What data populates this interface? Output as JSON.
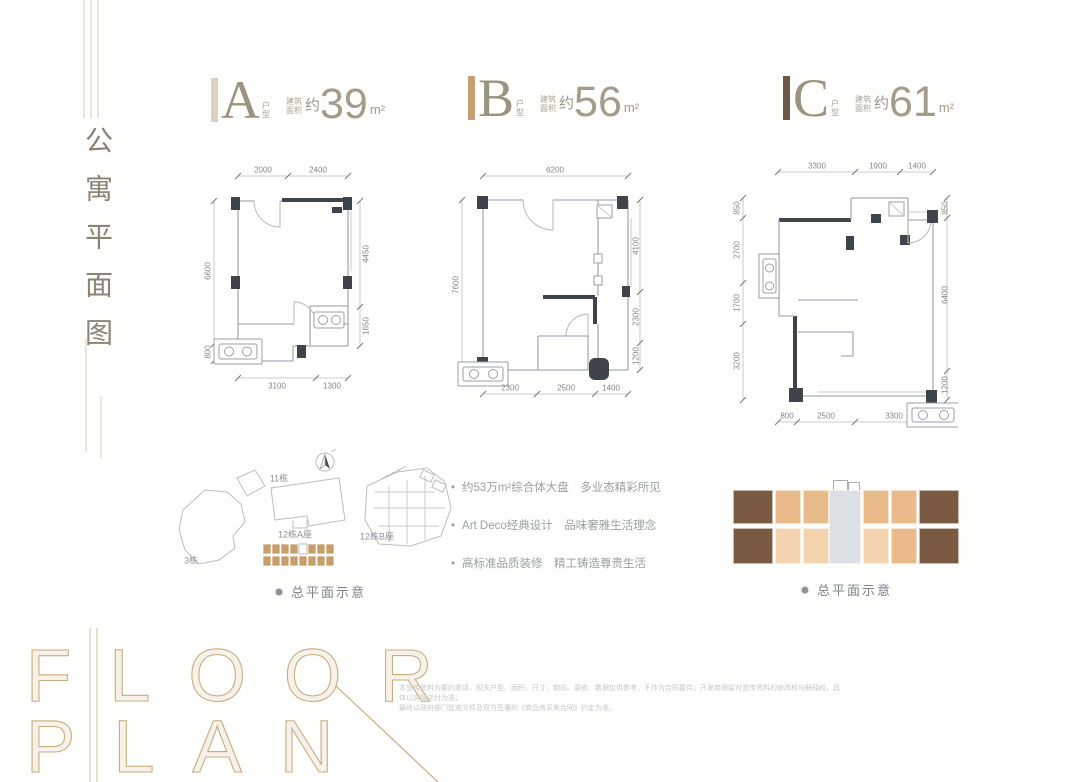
{
  "page_title": "公寓平面图",
  "watermark": {
    "line1": "FLOOR",
    "line2": "PLAN",
    "accent_color": "#c8ad80"
  },
  "units": [
    {
      "letter": "A",
      "type_label_1": "户",
      "type_label_2": "型",
      "area_prefix_1": "建筑",
      "area_prefix_2": "面积",
      "approx": "约",
      "area_value": "39",
      "area_unit": "m²",
      "bar_color": "#dad2c3"
    },
    {
      "letter": "B",
      "type_label_1": "户",
      "type_label_2": "型",
      "area_prefix_1": "建筑",
      "area_prefix_2": "面积",
      "approx": "约",
      "area_value": "56",
      "area_unit": "m²",
      "bar_color": "#c59e72"
    },
    {
      "letter": "C",
      "type_label_1": "户",
      "type_label_2": "型",
      "area_prefix_1": "建筑",
      "area_prefix_2": "面积",
      "approx": "约",
      "area_value": "61",
      "area_unit": "m²",
      "bar_color": "#6d5847"
    }
  ],
  "floorplans": {
    "a": {
      "dims": [
        {
          "t": "2000",
          "x": 65,
          "y": 14
        },
        {
          "t": "2400",
          "x": 120,
          "y": 14
        },
        {
          "t": "6600",
          "x": 10,
          "y": 115,
          "v": 1
        },
        {
          "t": "800",
          "x": 10,
          "y": 196,
          "v": 1
        },
        {
          "t": "4450",
          "x": 168,
          "y": 98,
          "v": 1
        },
        {
          "t": "1650",
          "x": 168,
          "y": 170,
          "v": 1
        },
        {
          "t": "3100",
          "x": 79,
          "y": 230
        },
        {
          "t": "1300",
          "x": 134,
          "y": 230
        }
      ]
    },
    "b": {
      "dims": [
        {
          "t": "6200",
          "x": 107,
          "y": 12
        },
        {
          "t": "7600",
          "x": 8,
          "y": 127,
          "v": 1
        },
        {
          "t": "4100",
          "x": 188,
          "y": 88,
          "v": 1
        },
        {
          "t": "2300",
          "x": 188,
          "y": 159,
          "v": 1
        },
        {
          "t": "1200",
          "x": 188,
          "y": 198,
          "v": 1
        },
        {
          "t": "2300",
          "x": 62,
          "y": 230
        },
        {
          "t": "2500",
          "x": 118,
          "y": 230
        },
        {
          "t": "1400",
          "x": 163,
          "y": 230
        }
      ]
    },
    "c": {
      "dims": [
        {
          "t": "3300",
          "x": 94,
          "y": 16
        },
        {
          "t": "1900",
          "x": 155,
          "y": 16
        },
        {
          "t": "1400",
          "x": 194,
          "y": 16
        },
        {
          "t": "850",
          "x": 14,
          "y": 58,
          "v": 1
        },
        {
          "t": "2700",
          "x": 14,
          "y": 100,
          "v": 1
        },
        {
          "t": "1700",
          "x": 14,
          "y": 153,
          "v": 1
        },
        {
          "t": "3200",
          "x": 14,
          "y": 211,
          "v": 1
        },
        {
          "t": "850",
          "x": 222,
          "y": 58,
          "v": 1
        },
        {
          "t": "6400",
          "x": 222,
          "y": 145,
          "v": 1
        },
        {
          "t": "1200",
          "x": 222,
          "y": 235,
          "v": 1
        },
        {
          "t": "800",
          "x": 64,
          "y": 266
        },
        {
          "t": "2500",
          "x": 103,
          "y": 266
        },
        {
          "t": "3300",
          "x": 171,
          "y": 266
        }
      ]
    }
  },
  "siteplan": {
    "labels": [
      {
        "t": "11栋",
        "x": 104,
        "y": 30
      },
      {
        "t": "12栋A座",
        "x": 120,
        "y": 86
      },
      {
        "t": "12栋B座",
        "x": 202,
        "y": 88
      },
      {
        "t": "3栋",
        "x": 16,
        "y": 112
      }
    ],
    "caption": "总平面示意"
  },
  "features": {
    "bullets": [
      "约53万m²综合体大盘　多业态精彩所见",
      "Art Deco经典设计　品味奢雅生活理念",
      "高标准品质装修　精工铸造尊贵生活"
    ]
  },
  "floorplate": {
    "caption": "总平面示意",
    "colors": {
      "dark": "#7a5a40",
      "tan": "#e9ba8a",
      "light": "#f3d4ae",
      "core": "#dce0e5"
    },
    "units": [
      {
        "x": 0,
        "y": 2,
        "w": 40,
        "h": 34,
        "c": "dark"
      },
      {
        "x": 0,
        "y": 40,
        "w": 40,
        "h": 36,
        "c": "dark"
      },
      {
        "x": 42,
        "y": 2,
        "w": 26,
        "h": 34,
        "c": "tan"
      },
      {
        "x": 70,
        "y": 2,
        "w": 26,
        "h": 34,
        "c": "tan"
      },
      {
        "x": 130,
        "y": 2,
        "w": 26,
        "h": 34,
        "c": "tan"
      },
      {
        "x": 158,
        "y": 2,
        "w": 26,
        "h": 34,
        "c": "tan"
      },
      {
        "x": 96,
        "y": 2,
        "w": 32,
        "h": 74,
        "c": "core"
      },
      {
        "x": 42,
        "y": 40,
        "w": 26,
        "h": 36,
        "c": "light"
      },
      {
        "x": 70,
        "y": 40,
        "w": 26,
        "h": 36,
        "c": "light"
      },
      {
        "x": 130,
        "y": 40,
        "w": 26,
        "h": 36,
        "c": "light"
      },
      {
        "x": 158,
        "y": 40,
        "w": 26,
        "h": 36,
        "c": "tan"
      },
      {
        "x": 186,
        "y": 2,
        "w": 40,
        "h": 34,
        "c": "dark"
      },
      {
        "x": 186,
        "y": 40,
        "w": 40,
        "h": 36,
        "c": "dark"
      }
    ]
  },
  "disclaimer": {
    "line1": "本宣传资料为要约邀请，相关户型、面积、尺寸、朝向、装修、数据仅供参考，不作为合同要件；开发商保留对宣传资料的修改权与解释权，具体以实际交付为准；",
    "line2": "最终以政府部门批准文件及双方签署的《商品房买卖合同》约定为准。"
  }
}
